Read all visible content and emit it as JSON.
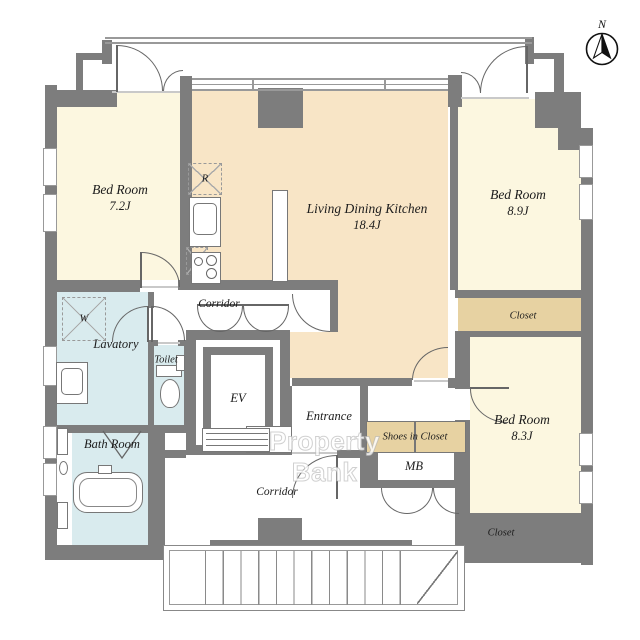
{
  "compass": {
    "north_label": "N"
  },
  "watermark": {
    "text": "Property Bank"
  },
  "rooms": {
    "bedroom_1": {
      "name": "Bed Room",
      "size": "7.2J"
    },
    "living_dining_kitchen": {
      "name": "Living Dining Kitchen",
      "size": "18.4J"
    },
    "bedroom_2": {
      "name": "Bed Room",
      "size": "8.9J"
    },
    "bedroom_3": {
      "name": "Bed Room",
      "size": "8.3J"
    },
    "lavatory": {
      "name": "Lavatory"
    },
    "toilet": {
      "name": "Toilet"
    },
    "bath_room": {
      "name": "Bath Room"
    },
    "corridor_upper": {
      "name": "Corridor"
    },
    "corridor_lower": {
      "name": "Corridor"
    },
    "entrance": {
      "name": "Entrance"
    },
    "shoes_in_closet": {
      "name": "Shoes in Closet"
    },
    "meter_box": {
      "name": "MB"
    },
    "elevator": {
      "name": "EV"
    },
    "closet_east": {
      "name": "Closet"
    },
    "closet_south": {
      "name": "Closet"
    }
  },
  "fixtures": {
    "washing_machine": "W",
    "refrigerator": "R"
  },
  "colors": {
    "wall": "#7d7d7d",
    "bedroom_floor": "#fcf7e0",
    "ldk_floor": "#f8e5c6",
    "wet_area_floor": "#d9ebee",
    "closet_floor": "#e7d2a2",
    "outline": "#666666"
  }
}
